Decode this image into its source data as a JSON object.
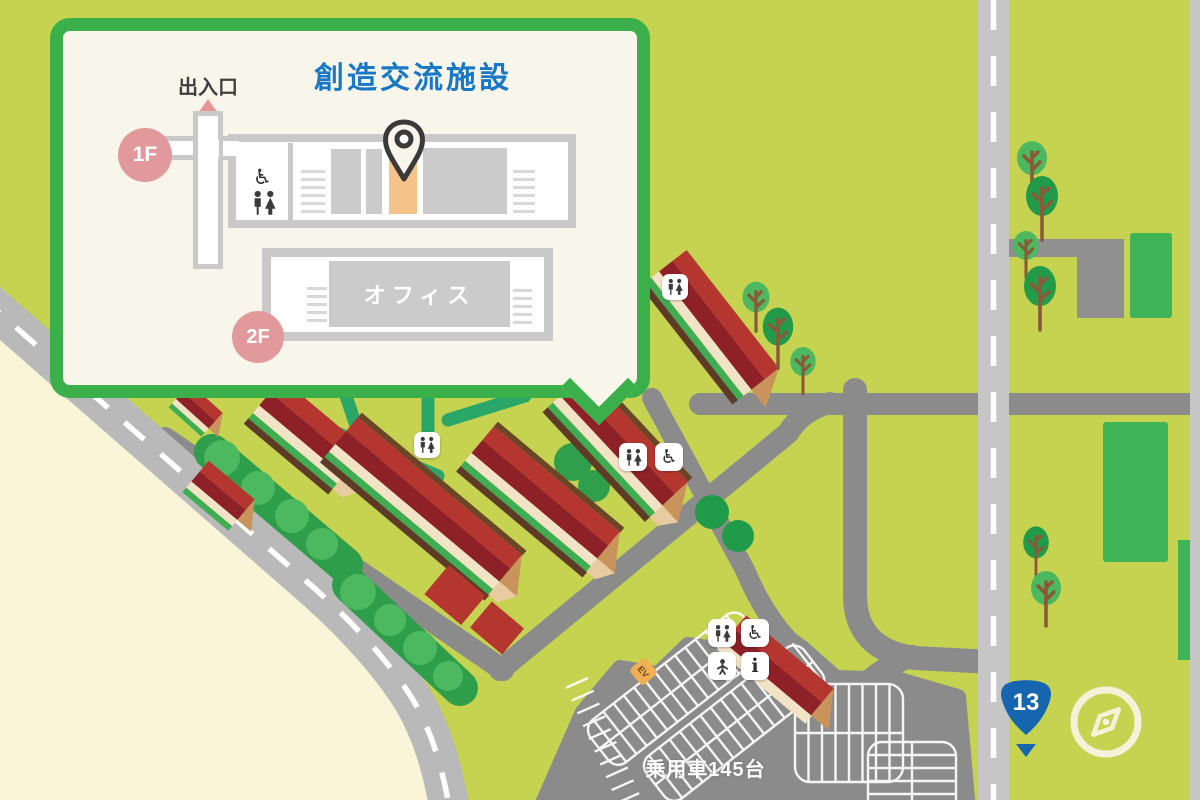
{
  "popup": {
    "title": "創造交流施設",
    "entrance_label": "出入口",
    "floor1_badge": "1F",
    "floor2_badge": "2F",
    "office_label": "オフィス"
  },
  "map": {
    "parking_label": "乗用車145台",
    "route_shield": "13",
    "ev_sign": "EV"
  },
  "icons": {
    "wheelchair": "♿",
    "info": "i",
    "restroom": "restroom-man-woman-icon",
    "baby": "baby-icon",
    "pin": "location-pin-icon",
    "compass": "compass-icon"
  },
  "colors": {
    "grass": "#c5d351",
    "sand": "#faf4d8",
    "coast_road": "#b9b9b9",
    "highway": "#c6c6c6",
    "service_road": "#8b8b8b",
    "roof_red": "#b5352f",
    "roof_dark_red": "#8e2027",
    "wall_cream": "#f3e3c6",
    "hedge_green": "#2f9e4a",
    "tree_light_green": "#4cb85f",
    "tree_dark_green": "#219a49",
    "field_green": "#3fb457",
    "footpath_teal": "#2aa768",
    "popup_border": "#3bb04a",
    "popup_bg": "#f8f6ea",
    "title_blue": "#1878c8",
    "floor_badge_pink": "#e2999b",
    "room_gray": "#cbcbcb",
    "highlight_orange": "#f5c289",
    "shield_blue": "#1566ae"
  }
}
